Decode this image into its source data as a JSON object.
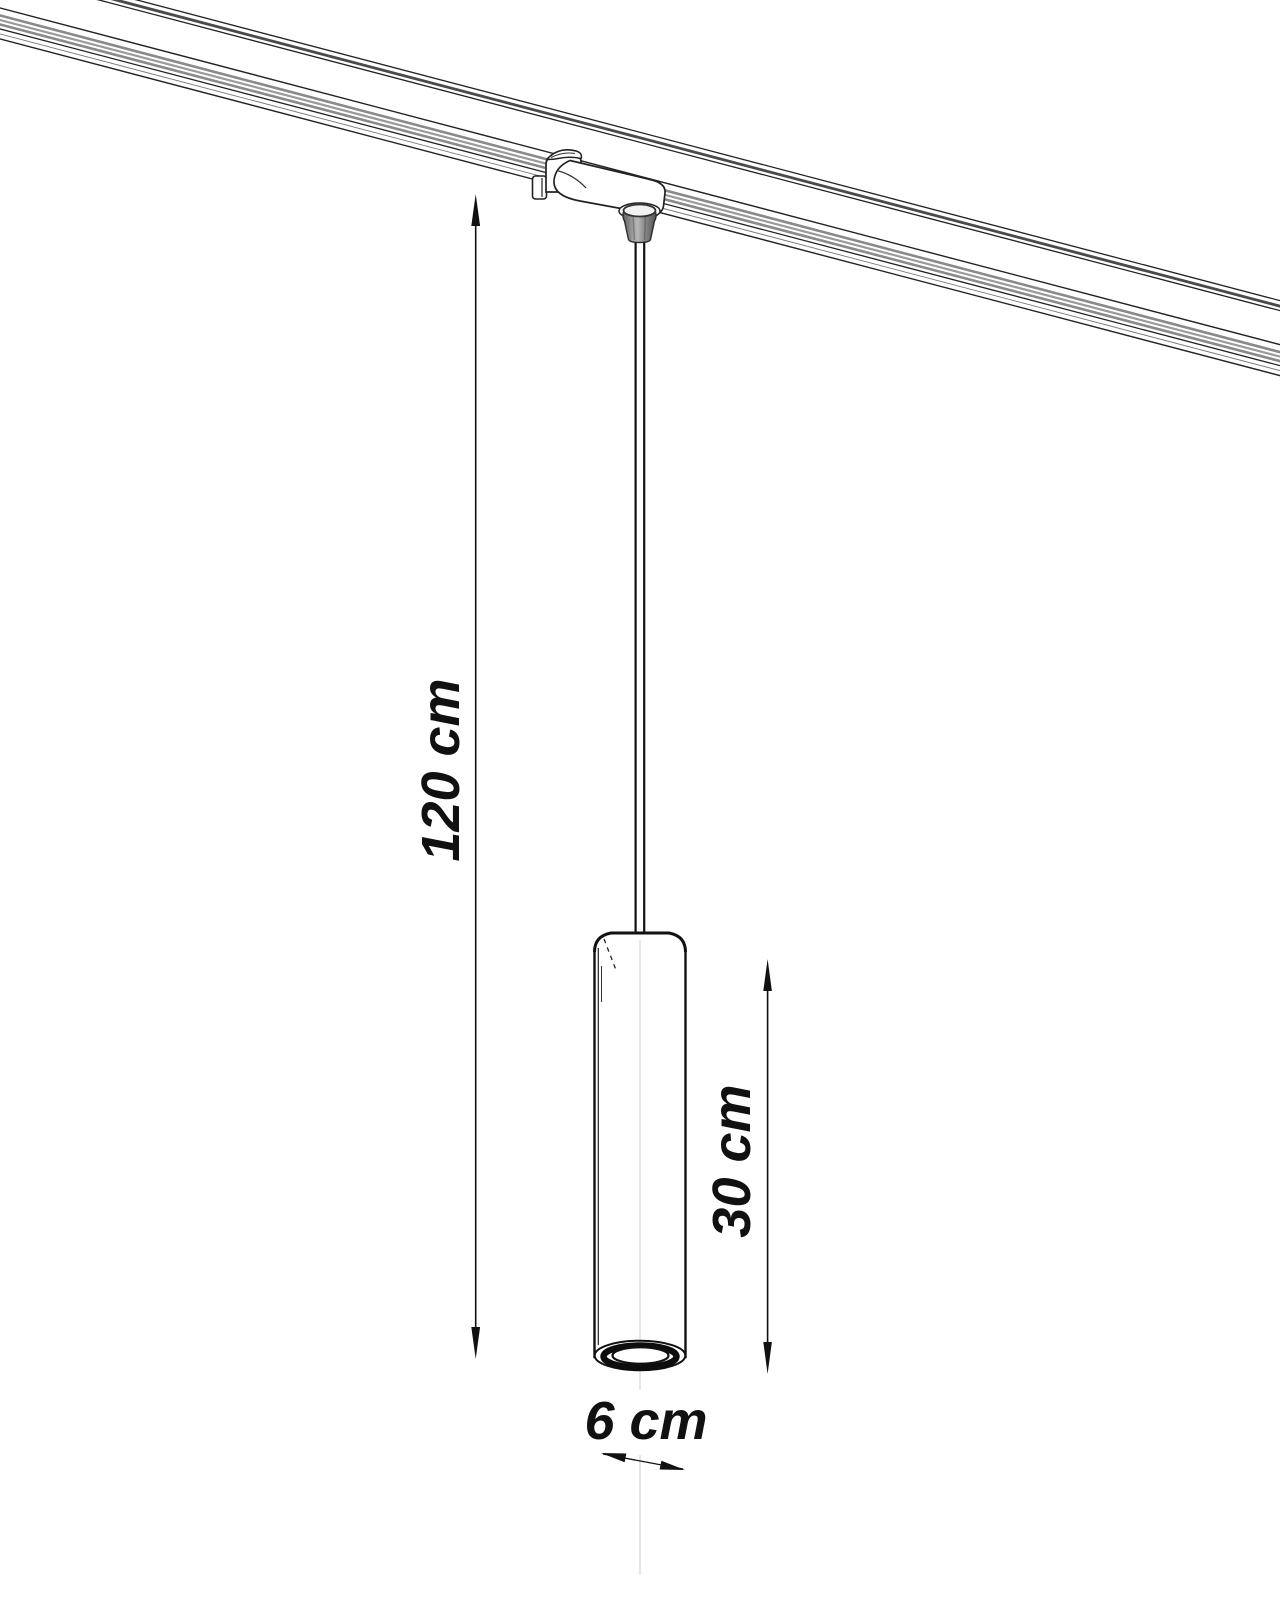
{
  "page": {
    "background": "#ffffff",
    "width_px": 1280,
    "height_px": 1600
  },
  "drawing": {
    "kind": "technical-dimension-line-drawing",
    "subject": "cylindrical pendant spotlight hanging by a cable from a track adapter on a ceiling track rail",
    "line_color": "#111111",
    "track_groove_color": "#8a8a8a",
    "cone_shade_color": "#8f8f8f"
  },
  "dimensions": {
    "drop_height": {
      "label": "120 cm",
      "value": 120,
      "unit": "cm"
    },
    "shade_height": {
      "label": "30 cm",
      "value": 30,
      "unit": "cm"
    },
    "shade_diameter": {
      "label": "6 cm",
      "value": 6,
      "unit": "cm"
    }
  }
}
